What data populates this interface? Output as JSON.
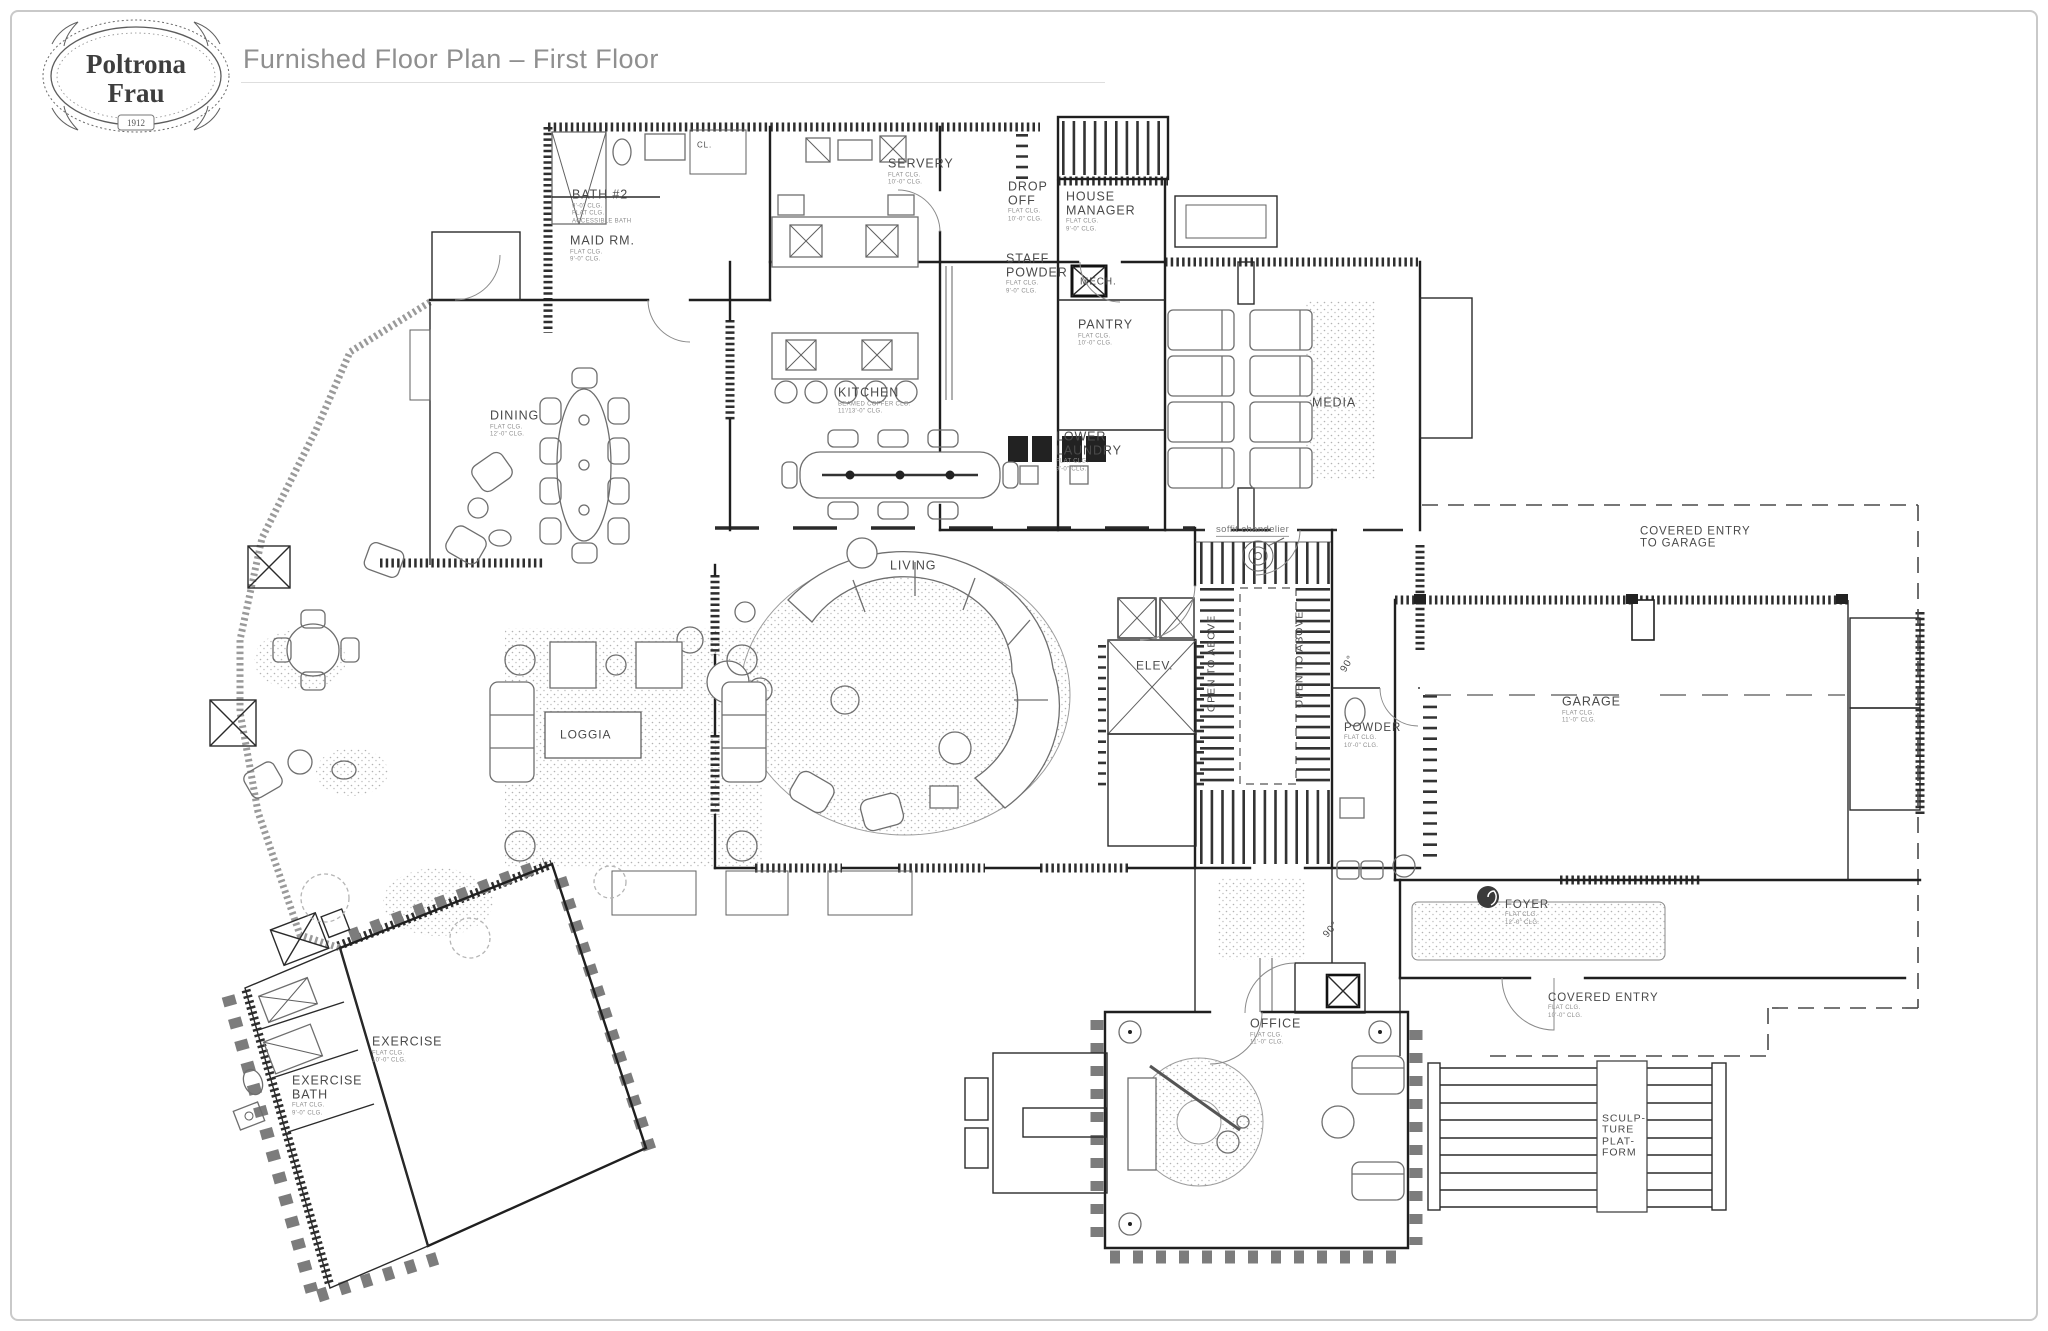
{
  "header": {
    "logo": {
      "name1": "Poltrona",
      "name2": "Frau",
      "year": "1912"
    },
    "title": "Furnished Floor Plan – First Floor"
  },
  "plan": {
    "labels": [
      {
        "id": "bath-2",
        "lines": [
          "BATH #2"
        ],
        "sub": [
          "9'-0\" CLG.",
          "FLAT CLG.",
          "ACCESSIBLE BATH"
        ],
        "x": 572,
        "y": 207
      },
      {
        "id": "maid-rm",
        "lines": [
          "MAID RM."
        ],
        "sub": [
          "FLAT CLG.",
          "9'-0\" CLG."
        ],
        "x": 570,
        "y": 249
      },
      {
        "id": "closet-cl",
        "lines": [
          "CL."
        ],
        "x": 697,
        "y": 146,
        "fs": 8
      },
      {
        "id": "servery",
        "lines": [
          "SERVERY"
        ],
        "sub": [
          "FLAT CLG.",
          "10'-0\" CLG."
        ],
        "x": 888,
        "y": 172
      },
      {
        "id": "drop-off",
        "lines": [
          "DROP",
          "OFF"
        ],
        "sub": [
          "FLAT CLG.",
          "10'-0\" CLG."
        ],
        "x": 1008,
        "y": 202
      },
      {
        "id": "house-manager",
        "lines": [
          "HOUSE",
          "MANAGER"
        ],
        "sub": [
          "FLAT CLG.",
          "9'-0\" CLG."
        ],
        "x": 1066,
        "y": 212
      },
      {
        "id": "staff-powder",
        "lines": [
          "STAFF",
          "POWDER"
        ],
        "sub": [
          "FLAT CLG.",
          "9'-0\" CLG."
        ],
        "x": 1006,
        "y": 274
      },
      {
        "id": "mech",
        "lines": [
          "MECH."
        ],
        "x": 1080,
        "y": 283,
        "fs": 10
      },
      {
        "id": "pantry",
        "lines": [
          "PANTRY"
        ],
        "sub": [
          "FLAT CLG.",
          "10'-0\" CLG."
        ],
        "x": 1078,
        "y": 333
      },
      {
        "id": "kitchen",
        "lines": [
          "KITCHEN"
        ],
        "sub": [
          "BEAMED COFFER CLG.",
          "11'/13'-0\" CLG."
        ],
        "x": 838,
        "y": 401
      },
      {
        "id": "lower-laundry",
        "lines": [
          "LOWER",
          "LAUNDRY"
        ],
        "sub": [
          "FLAT CLG.",
          "9'-0\" CLG."
        ],
        "x": 1056,
        "y": 452
      },
      {
        "id": "media",
        "lines": [
          "MEDIA"
        ],
        "x": 1312,
        "y": 403,
        "fs": 12.5
      },
      {
        "id": "dining",
        "lines": [
          "DINING"
        ],
        "sub": [
          "FLAT CLG.",
          "12'-0\" CLG."
        ],
        "x": 490,
        "y": 424
      },
      {
        "id": "living",
        "lines": [
          "LIVING"
        ],
        "x": 890,
        "y": 566,
        "fs": 12.5
      },
      {
        "id": "loggia",
        "lines": [
          "LOGGIA"
        ],
        "x": 560,
        "y": 735,
        "fs": 12
      },
      {
        "id": "elev",
        "lines": [
          "ELEV."
        ],
        "x": 1136,
        "y": 666,
        "fs": 12
      },
      {
        "id": "open-to-above-left",
        "lines": [
          "OPEN TO ABOVE"
        ],
        "x": 1212,
        "y": 712,
        "rot": -90,
        "fs": 10.5
      },
      {
        "id": "open-to-above-right",
        "lines": [
          "OPEN TO ABOVE"
        ],
        "x": 1300,
        "y": 708,
        "rot": -90,
        "fs": 10.5
      },
      {
        "id": "powder",
        "lines": [
          "POWDER"
        ],
        "sub": [
          "FLAT CLG.",
          "10'-0\" CLG."
        ],
        "x": 1344,
        "y": 736,
        "fs": 11.5
      },
      {
        "id": "garage",
        "lines": [
          "GARAGE"
        ],
        "sub": [
          "FLAT CLG.",
          "11'-0\" CLG."
        ],
        "x": 1562,
        "y": 710
      },
      {
        "id": "covered-entry-to-garage",
        "lines": [
          "COVERED ENTRY",
          "TO GARAGE"
        ],
        "x": 1640,
        "y": 538,
        "fs": 11.5
      },
      {
        "id": "foyer",
        "lines": [
          "FOYER"
        ],
        "sub": [
          "FLAT CLG.",
          "12'-0\" CLG."
        ],
        "x": 1505,
        "y": 913,
        "fs": 11.5
      },
      {
        "id": "office",
        "lines": [
          "OFFICE"
        ],
        "sub": [
          "FLAT CLG.",
          "11'-0\" CLG."
        ],
        "x": 1250,
        "y": 1032
      },
      {
        "id": "covered-entry",
        "lines": [
          "COVERED ENTRY"
        ],
        "sub": [
          "FLAT CLG.",
          "10'-0\" CLG."
        ],
        "x": 1548,
        "y": 1006,
        "fs": 11.5
      },
      {
        "id": "sculpture-platform",
        "lines": [
          "SCULP-",
          "TURE",
          "PLAT-",
          "FORM"
        ],
        "x": 1602,
        "y": 1136,
        "fs": 10.5
      },
      {
        "id": "exercise",
        "lines": [
          "EXERCISE"
        ],
        "sub": [
          "FLAT CLG.",
          "10'-0\" CLG."
        ],
        "x": 372,
        "y": 1050
      },
      {
        "id": "exercise-bath",
        "lines": [
          "EXERCISE",
          "BATH"
        ],
        "sub": [
          "FLAT CLG.",
          "9'-0\" CLG."
        ],
        "x": 292,
        "y": 1096
      },
      {
        "id": "soffit-chandelier",
        "lines": [
          "soffit chandelier"
        ],
        "x": 1216,
        "y": 531,
        "fs": 9.5,
        "cls": "annot"
      },
      {
        "id": "door-angle-foyer",
        "lines": [
          "90°"
        ],
        "x": 1326,
        "y": 937,
        "rot": -50,
        "fs": 10
      },
      {
        "id": "door-angle-powder",
        "lines": [
          "90°"
        ],
        "x": 1344,
        "y": 672,
        "rot": -60,
        "fs": 10
      }
    ]
  }
}
